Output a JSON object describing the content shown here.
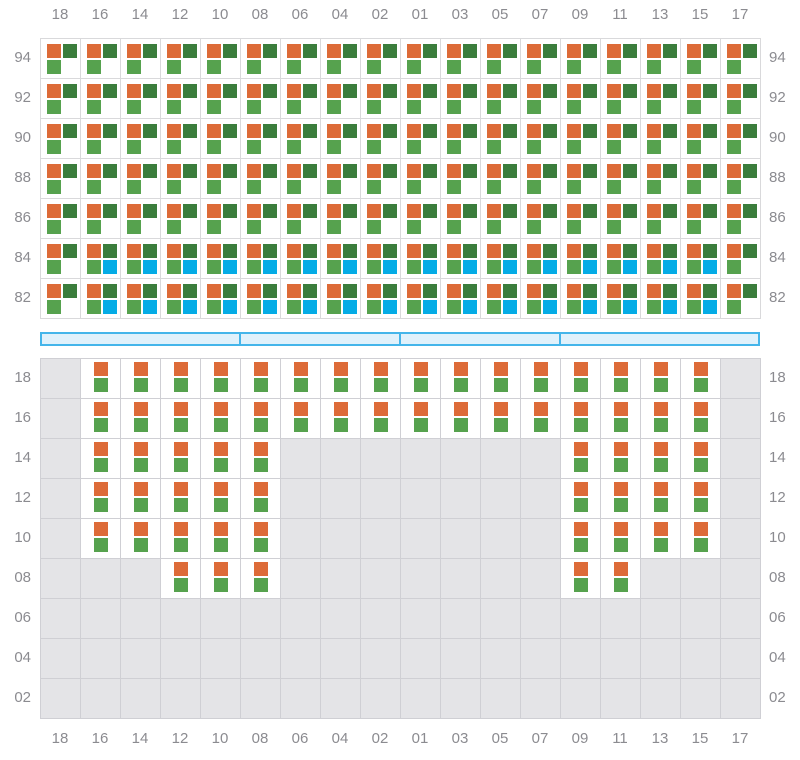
{
  "colors": {
    "orange": "#DD6B38",
    "dark_green": "#3B7D3C",
    "light_green": "#56A24E",
    "blue": "#04ACE6",
    "label": "#8B8B90",
    "upper_line": "#D9D9DB",
    "lower_line": "#CFCFD4",
    "lower_bg": "#E4E4E7",
    "aisle_fill": "#E0F1FB",
    "aisle_border": "#44B5EA"
  },
  "top_axis": {
    "labels": [
      "18",
      "16",
      "14",
      "12",
      "10",
      "08",
      "06",
      "04",
      "02",
      "01",
      "03",
      "05",
      "07",
      "09",
      "11",
      "13",
      "15",
      "17"
    ]
  },
  "bottom_axis": {
    "labels": [
      "18",
      "16",
      "14",
      "12",
      "10",
      "08",
      "06",
      "04",
      "02",
      "01",
      "03",
      "05",
      "07",
      "09",
      "11",
      "13",
      "15",
      "17"
    ]
  },
  "upper_grid": {
    "row_labels": [
      "94",
      "92",
      "90",
      "88",
      "86",
      "84",
      "82"
    ],
    "row_patterns": [
      "tttttttttttttttttt",
      "tttttttttttttttttt",
      "tttttttttttttttttt",
      "tttttttttttttttttt",
      "tttttttttttttttttt",
      "tqqqqqqqqqqqqqqqqt",
      "tqqqqqqqqqqqqqqqqt"
    ],
    "cell_legend": {
      "t": "orange + dark-green + light-green squares",
      "q": "orange + dark-green + light-green + blue squares"
    }
  },
  "lower_grid": {
    "row_labels": [
      "18",
      "16",
      "14",
      "12",
      "10",
      "08",
      "06",
      "04",
      "02"
    ],
    "row_patterns": [
      ".pppppppppppppppp.",
      ".pppppppppppppppp.",
      ".ppppp.......pppp.",
      ".ppppp.......pppp.",
      ".ppppp.......pppp.",
      "...ppp.......pp...",
      "..................",
      "..................",
      ".................."
    ],
    "cell_legend": {
      "p": "orange square over light-green square",
      ".": "empty"
    }
  },
  "aisle": {
    "segment_widths": [
      200,
      160,
      160,
      200
    ]
  }
}
